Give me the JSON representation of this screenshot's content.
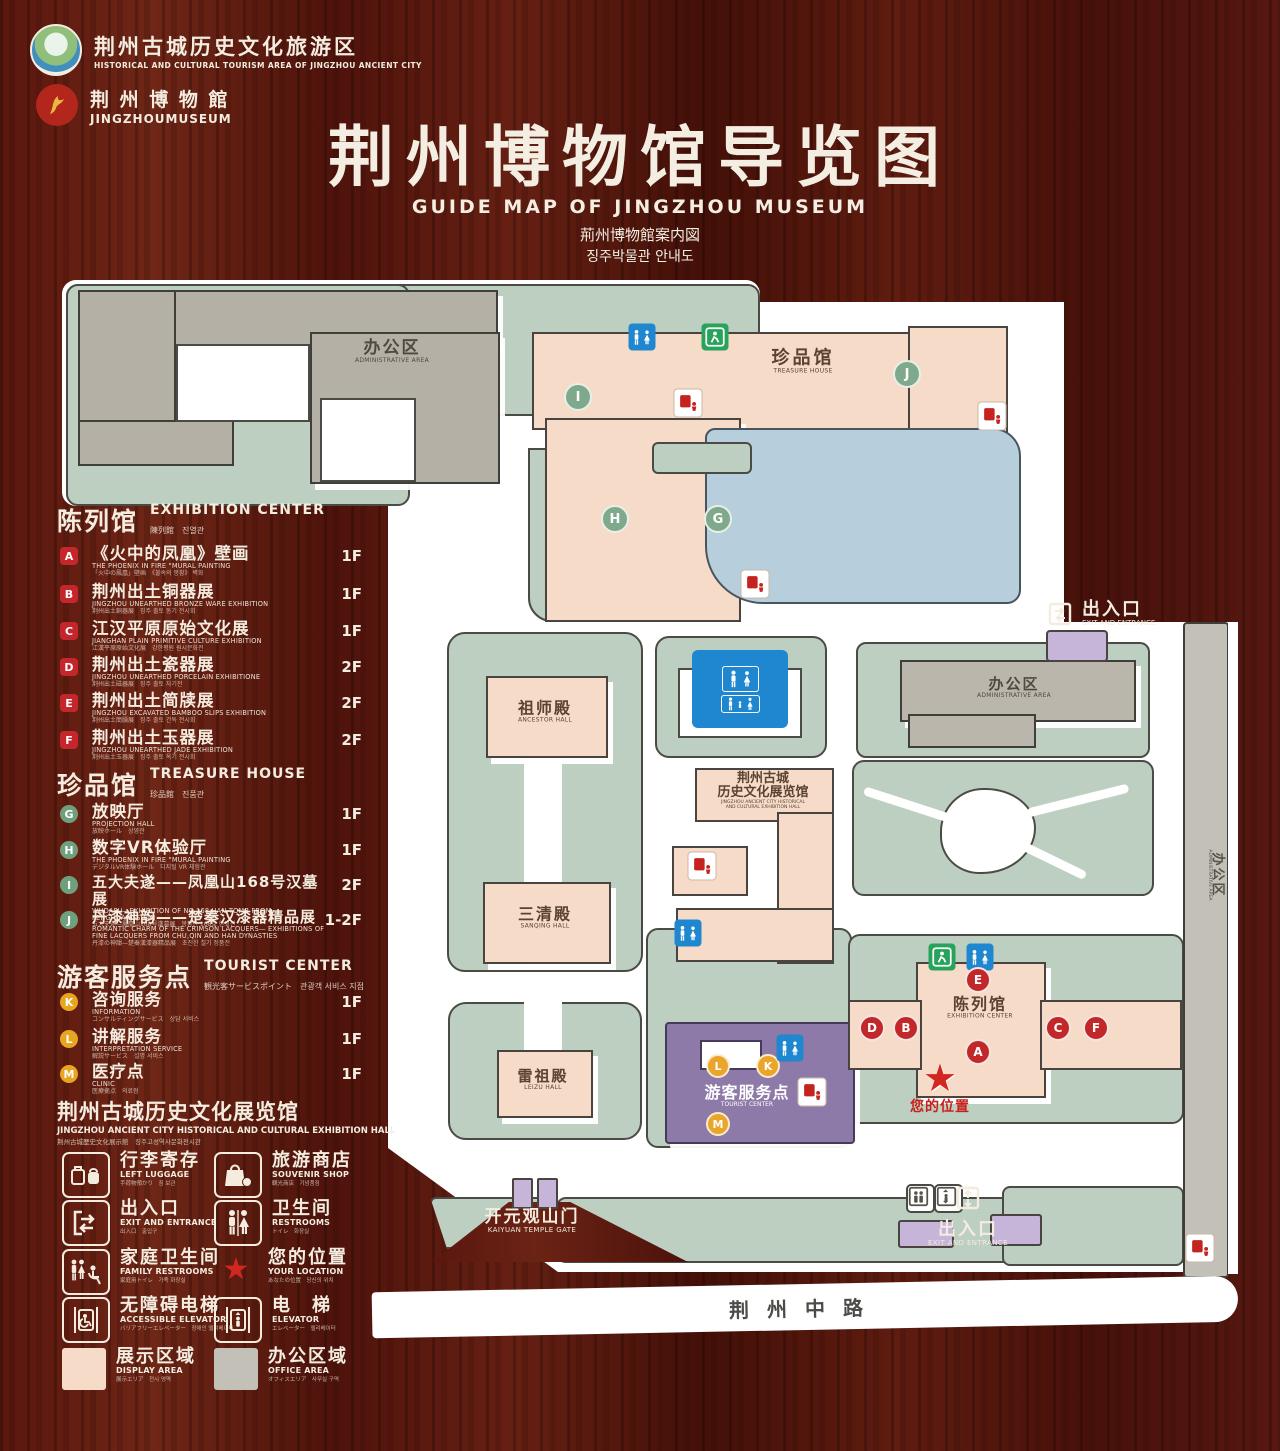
{
  "header": {
    "logo1": {
      "cn": "荆州古城历史文化旅游区",
      "en": "HISTORICAL AND CULTURAL TOURISM AREA OF JINGZHOU ANCIENT CITY"
    },
    "logo2": {
      "cn": "荆 州 博 物 館",
      "en": "JINGZHOUMUSEUM"
    },
    "title_cn": "荆州博物馆导览图",
    "title_en": "GUIDE MAP OF JINGZHOU MUSEUM",
    "title_jp": "荊州博物館案内図",
    "title_kr": "징주박물관 안내도"
  },
  "legend": {
    "sections": [
      {
        "title_cn": "陈列馆",
        "title_en": "EXHIBITION CENTER",
        "title_sub": "陳列館　진열관",
        "items": [
          {
            "key": "A",
            "title": "《火中的凤凰》壁画",
            "en": "THE PHOENIX IN FIRE \"MURAL PAINTING",
            "sub": "「火中の鳳凰」壁画　《불속의 봉황》 벽화",
            "floor": "1F"
          },
          {
            "key": "B",
            "title": "荆州出土铜器展",
            "en": "JINGZHOU UNEARTHED BRONZE WARE EXHIBITION",
            "sub": "荆州出土銅器展　징주 출토 동기 전시회",
            "floor": "1F"
          },
          {
            "key": "C",
            "title": "江汉平原原始文化展",
            "en": "JIANGHAN PLAIN PRIMITIVE CULTURE EXHIBITION",
            "sub": "江漢平原原始文化展　강한평원 원시문화전",
            "floor": "1F"
          },
          {
            "key": "D",
            "title": "荆州出土瓷器展",
            "en": "JINGZHOU UNEARTHED PORCELAIN EXHIBITIONE",
            "sub": "荆州出土磁器展　징주 출토 자기전",
            "floor": "2F"
          },
          {
            "key": "E",
            "title": "荆州出土简牍展",
            "en": "JINGZHOU EXCAVATED BAMBOO SLIPS EXHIBITION",
            "sub": "荆州出土簡牘展　징주 출토 간독 전시회",
            "floor": "2F"
          },
          {
            "key": "F",
            "title": "荆州出土玉器展",
            "en": "JINGZHOU UNEARTHED JADE EXHIBITION",
            "sub": "荆州出土玉器展　징주 출토 옥기 전시회",
            "floor": "2F"
          }
        ]
      },
      {
        "title_cn": "珍品馆",
        "title_en": "TREASURE HOUSE",
        "title_sub": "珍品館　진품관",
        "items": [
          {
            "key": "G",
            "title": "放映厅",
            "en": "PROJECTION HALL",
            "sub": "放映ホール　상영관",
            "floor": "1F"
          },
          {
            "key": "H",
            "title": "数字VR体验厅",
            "en": "THE PHOENIX IN FIRE \"MURAL PAINTING",
            "sub": "デジタルVR体験ホール　디지털 VR 체험관",
            "floor": "1F"
          },
          {
            "key": "I",
            "title": "五大夫遂——凤凰山168号汉墓展",
            "en": "WUDAFU—EXHIBITION OF NO.168 HAN TOMB FROM FENGHUANGSHAN",
            "sub": "五大夫遂—鳳凰山168号漢墓展　봉황산 168호 한묘전",
            "floor": "2F"
          },
          {
            "key": "J",
            "title": "丹漆神韵——楚秦汉漆器精品展",
            "en": "ROMANTIC CHARM OF THE CRIMSON LACQUERS— EXHIBITIONS OF FINE LACQUERS FROM CHU,QIN AND HAN DYNASTIES",
            "sub": "丹漆の神韻—楚秦漢漆器精品展　초진한 칠기 정품전",
            "floor": "1-2F"
          }
        ]
      },
      {
        "title_cn": "游客服务点",
        "title_en": "TOURIST CENTER",
        "title_sub": "観光客サービスポイント　관광객 서비스 지점",
        "items": [
          {
            "key": "K",
            "title": "咨询服务",
            "en": "INFORMATION",
            "sub": "コンサルティングサービス　상담 서비스",
            "floor": "1F"
          },
          {
            "key": "L",
            "title": "讲解服务",
            "en": "INTERPRETATION SERVICE",
            "sub": "解説サービス　설명 서비스",
            "floor": "1F"
          },
          {
            "key": "M",
            "title": "医疗点",
            "en": "CLINIC",
            "sub": "医療拠点　의료점",
            "floor": "1F"
          }
        ]
      }
    ],
    "hall_note": {
      "cn": "荆州古城历史文化展览馆",
      "en": "JINGZHOU ANCIENT CITY HISTORICAL AND CULTURAL EXHIBITION HALL",
      "sub": "荆州古城歴史文化展示館　징주고성역사문화전시관"
    },
    "symbols": [
      {
        "icon": "luggage",
        "cn": "行李寄存",
        "en": "LEFT LUGGAGE",
        "sub": "手荷物預かり　짐 보관"
      },
      {
        "icon": "shop",
        "cn": "旅游商店",
        "en": "SOUVENIR SHOP",
        "sub": "観光商店　기념품점"
      },
      {
        "icon": "exit",
        "cn": "出入口",
        "en": "EXIT AND ENTRANCE",
        "sub": "出入口　출입구"
      },
      {
        "icon": "wc",
        "cn": "卫生间",
        "en": "RESTROOMS",
        "sub": "トイレ　화장실"
      },
      {
        "icon": "family",
        "cn": "家庭卫生间",
        "en": "FAMILY RESTROOMS",
        "sub": "家庭用トイレ　가족 화장실"
      },
      {
        "icon": "star",
        "cn": "您的位置",
        "en": "YOUR LOCATION",
        "sub": "あなたの位置　당신의 위치"
      },
      {
        "icon": "lift-a",
        "cn": "无障碍电梯",
        "en": "ACCESSIBLE ELEVATOR",
        "sub": "バリアフリーエレベーター　장애인 엘리베이터"
      },
      {
        "icon": "lift",
        "cn": "电　梯",
        "en": "ELEVATOR",
        "sub": "エレベーター　엘리베이터"
      },
      {
        "icon": "display",
        "cn": "展示区域",
        "en": "DISPLAY AREA",
        "sub": "展示エリア　전시 영역"
      },
      {
        "icon": "office",
        "cn": "办公区域",
        "en": "OFFICE AREA",
        "sub": "オフィスエリア　사무실 구역"
      }
    ]
  },
  "map": {
    "labels": {
      "admin_cn": "办公区",
      "admin_en": "ADMINISTRATIVE AREA",
      "treasure_cn": "珍品馆",
      "treasure_en": "TREASURE HOUSE",
      "ancestor_cn": "祖师殿",
      "ancestor_en": "ANCESTOR HALL",
      "sanqing_cn": "三清殿",
      "sanqing_en": "SANQING HALL",
      "leizu_cn": "雷祖殿",
      "leizu_en": "LEIZU HALL",
      "hall_cn1": "荆州古城",
      "hall_cn2": "历史文化展览馆",
      "hall_en1": "JINGZHOU ANCIENT CITY HISTORICAL",
      "hall_en2": "AND CULTURAL EXHIBITION HALL",
      "tourist_cn": "游客服务点",
      "tourist_en": "TOURIST CENTER",
      "exhib_cn": "陈列馆",
      "exhib_en": "EXHIBITION CENTER",
      "gate_cn": "开元观山门",
      "gate_en": "KAIYUAN TEMPLE GATE",
      "exit_cn": "出入口",
      "exit_en": "EXIT AND ENTRANCE",
      "road": "荆州中路",
      "location_cn": "您的位置"
    },
    "markers": {
      "a": "A",
      "b": "B",
      "c": "C",
      "d": "D",
      "e": "E",
      "f": "F",
      "g": "G",
      "h": "H",
      "i": "I",
      "j": "J",
      "k": "K",
      "l": "L",
      "m": "M"
    }
  },
  "colors": {
    "wood": "#561811",
    "cream": "#f3ecdf",
    "sage_green": "#bccfc1",
    "display_pink": "#f6dcc8",
    "office_gray": "#b4b0a6",
    "pond_blue": "#b7cfdd",
    "tourist_purple": "#8d7aa8",
    "lavender": "#c6b4d9",
    "marker_red": "#c2282a",
    "marker_green": "#7fa98c",
    "marker_orange": "#eaa62a",
    "wc_blue": "#1f87cf",
    "exit_green": "#27a35c",
    "star_red": "#d42620"
  }
}
